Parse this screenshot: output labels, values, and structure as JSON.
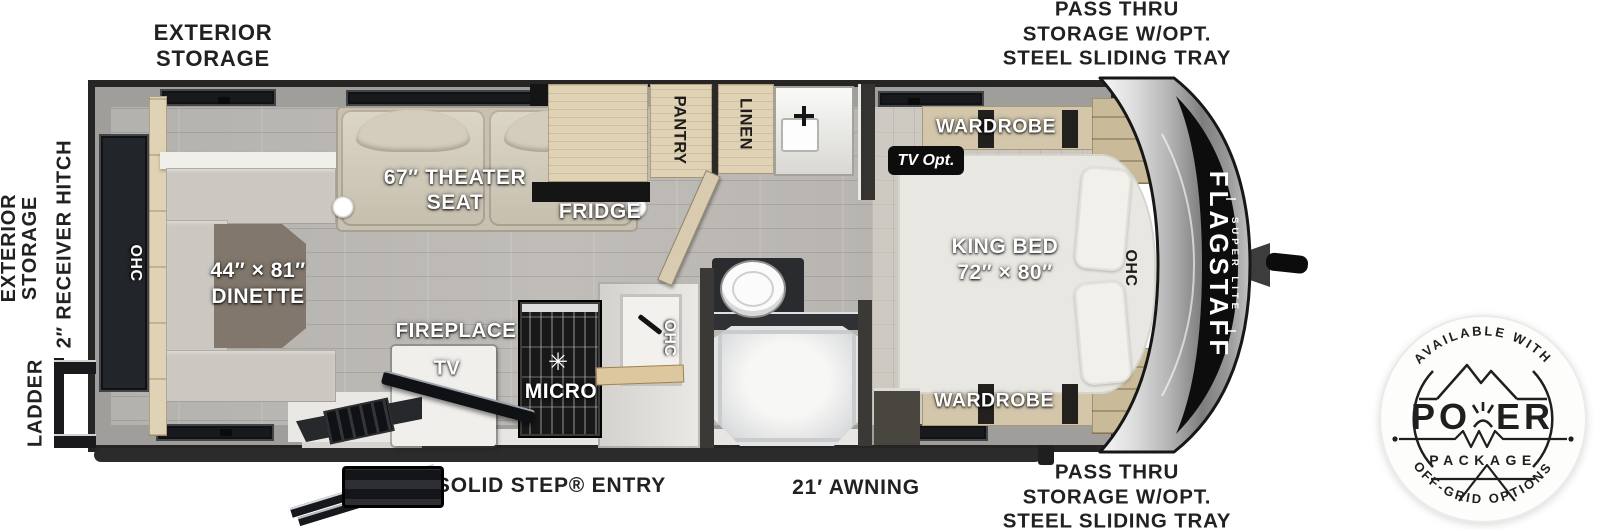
{
  "exterior": {
    "top_left": [
      "EXTERIOR",
      "STORAGE"
    ],
    "top_right": [
      "PASS THRU",
      "STORAGE W/OPT.",
      "STEEL SLIDING TRAY"
    ],
    "bottom_right": [
      "PASS THRU",
      "STORAGE W/OPT.",
      "STEEL SLIDING TRAY"
    ],
    "left_side": [
      "EXTERIOR",
      "STORAGE"
    ],
    "receiver_hitch": "2″ RECEIVER HITCH",
    "ladder": "LADDER",
    "solid_step_entry": "SOLID STEP® ENTRY",
    "awning": "21′ AWNING"
  },
  "interior": {
    "rear_ohc": "OHC",
    "dinette": [
      "44″ × 81″",
      "DINETTE"
    ],
    "theater": [
      "67″ THEATER",
      "SEAT"
    ],
    "fridge": "FRIDGE",
    "pantry": "PANTRY",
    "linen": "LINEN",
    "fireplace": "FIREPLACE",
    "tv": "TV",
    "micro": "MICRO",
    "kitchen_ohc": "OHC",
    "tv_opt": "TV Opt.",
    "wardrobe_top": "WARDROBE",
    "wardrobe_bottom": "WARDROBE",
    "king_bed": [
      "KING BED",
      "72″ × 80″"
    ],
    "front_ohc": "OHC"
  },
  "brand": {
    "name": "FLAGSTAFF",
    "sub": "SUPER LITE"
  },
  "badge": {
    "top_arc": "AVAILABLE WITH",
    "power_left": "PO",
    "power_right": "ER",
    "package": "PACKAGE",
    "bottom_arc": "OFF-GRID OPTIONS"
  },
  "colors": {
    "label_dark": "#232021",
    "body_black": "#262524",
    "floor": "#b8b6b2",
    "cabinet_wood": "#e0d3b5"
  }
}
